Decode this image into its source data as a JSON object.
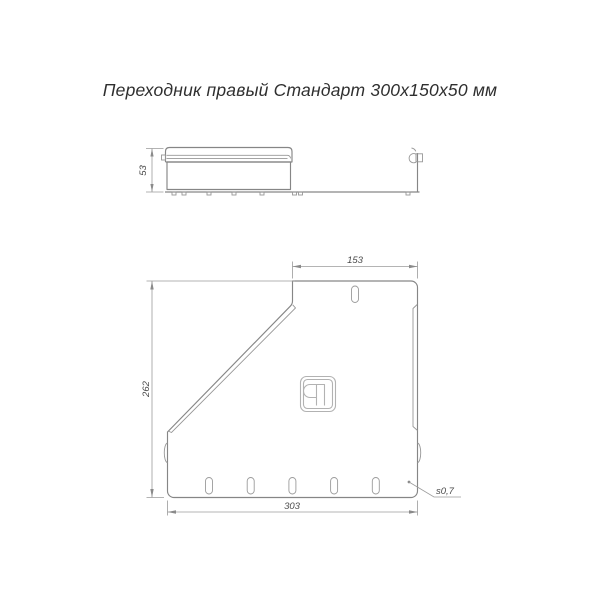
{
  "title": "Переходник правый Стандарт 300х150х50 мм",
  "side_view": {
    "height_dim": "53"
  },
  "plan_view": {
    "top_width_dim": "153",
    "left_height_dim": "262",
    "bottom_width_dim": "303",
    "thickness_note": "s0,7"
  },
  "logo": {
    "icon": "manufacturer-monogram-icon"
  },
  "colors": {
    "object_line": "#868686",
    "dim_line": "#9b9b9b",
    "dim_text": "#4a4a4a",
    "title_text": "#2f2f2f",
    "background": "#ffffff"
  }
}
